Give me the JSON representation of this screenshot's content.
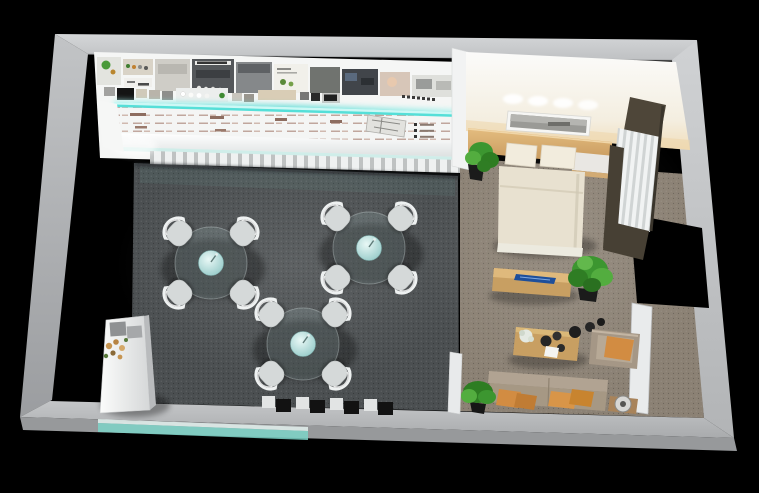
{
  "meta": {
    "type": "3d-interior-render",
    "view": "dollhouse top-down perspective",
    "description": "Showroom with product display wall, LED accent strip and three dining sets, beside a staged bedroom and lounge area"
  },
  "colors": {
    "background": "#000000",
    "wall_top": "#cbcdcf",
    "wall_left": "#b0b2b4",
    "wall_right": "#c3c5c7",
    "wall_bottom": "#b4b6b8",
    "wall_face_lower": "#97999b",
    "carpet_showroom": "#4b4f51",
    "carpet_lounge": "#8b8174",
    "display_backdrop": "#f5f6f5",
    "info_panel": "#f4f5f4",
    "led_cyan": "#55dfd8",
    "teal_baseboard": "#7cd3c8",
    "chair": "#d5d9d9",
    "chair_back": "#eef1f1",
    "vase_teal": "#9fd4d2",
    "bed_linen": "#e8e1d0",
    "pillow_white": "#f2ecdd",
    "headboard_wood": "#d9b173",
    "nightstand_white": "#e9e7e3",
    "poster_white": "#f6f6f4",
    "console_wood": "#c89f62",
    "decor_blue": "#1e4f9b",
    "sofa": "#a69884",
    "sofa_back": "#b1a392",
    "armchair": "#a59786",
    "cushion_orange": "#d28c42",
    "plant_green": "#3c9630",
    "plant_green_dark": "#2e7d22",
    "pot_black": "#1b1b1b",
    "curtain_sheer": "#eef0f0",
    "curtain_dark": "#4e4639",
    "counter_white": "#f0f1f1",
    "stand_black": "#121212",
    "door_leaf": "#e9ebec",
    "flower_tan": "#c69552"
  },
  "showroom": {
    "dining_sets": 3,
    "chairs_per_set": 4,
    "display_stands": 4,
    "items": [
      "product-display-wall",
      "led-accent-strip",
      "info-panel-rows",
      "material-sample-squares",
      "counter-shelf",
      "dining-set x3",
      "reception-desk",
      "flower-arrangement",
      "display-stand-row",
      "dark-speckled-carpet"
    ]
  },
  "bedroom": {
    "pillows": 2,
    "items": [
      "double-bed",
      "headboard-shelf",
      "wall-art-poster",
      "ceiling-spotlights",
      "potted-plant",
      "nightstand-ledge",
      "sheer-window-curtains"
    ]
  },
  "lounge": {
    "throw_pillows": 4,
    "items": [
      "media-console",
      "blue-decor-piece",
      "large-potted-plant",
      "coffee-table",
      "decor-vases",
      "armchair-orange-cushion",
      "sofa-orange-pillows",
      "side-table-lamp",
      "floor-plant",
      "door-opening",
      "white-door-leaf"
    ]
  }
}
